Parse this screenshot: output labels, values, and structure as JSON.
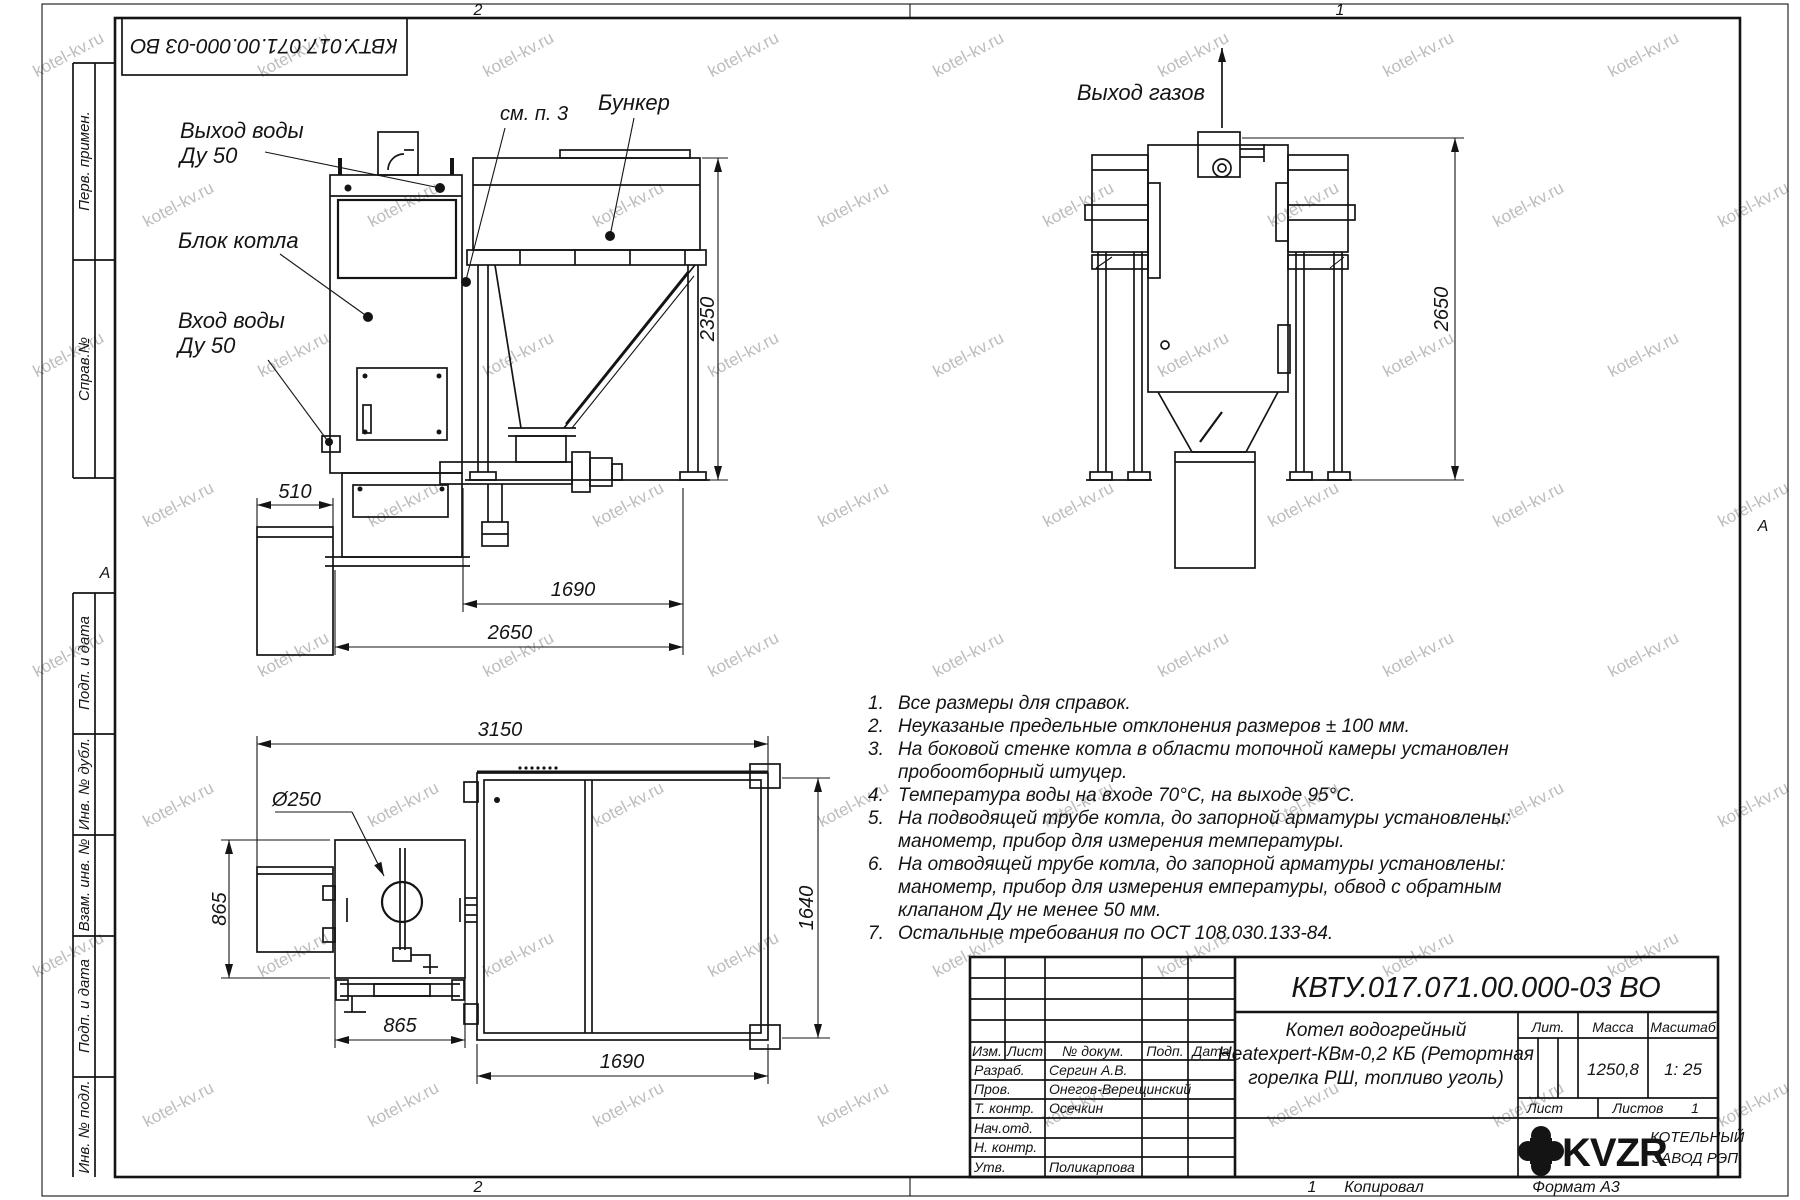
{
  "watermark": {
    "text": "kotel-kv.ru"
  },
  "margins": {
    "zone_top_left": "2",
    "zone_top_right": "1",
    "zone_bottom_left": "2",
    "zone_bottom_right": "1",
    "row_marker_left": "А",
    "row_marker_right": "А",
    "copied": "Копировал",
    "format": "Формат А3",
    "top_stamp": "КВТУ.017.071.00.000-03 ВО"
  },
  "sidebar": {
    "perv": "Перв. примен.",
    "sprav": "Справ.№",
    "podp1": "Подп. и дата",
    "inv_dubl": "Инв. № дубл.",
    "vzam": "Взам. инв. №",
    "podp2": "Подп. и дата",
    "inv_podl": "Инв. № подл."
  },
  "front_view": {
    "water_out_line1": "Выход воды",
    "water_out_line2": "Ду 50",
    "boiler_block": "Блок котла",
    "water_in_line1": "Вход воды",
    "water_in_line2": "Ду 50",
    "see_note": "см. п. 3",
    "bunker": "Бункер",
    "dim_510": "510",
    "dim_2350": "2350",
    "dim_1690": "1690",
    "dim_2650": "2650"
  },
  "side_view": {
    "gas_out": "Выход газов",
    "dim_2650": "2650"
  },
  "top_view": {
    "dim_3150": "3150",
    "dim_diameter": "Ø250",
    "dim_865_left": "865",
    "dim_865_bottom": "865",
    "dim_1690": "1690",
    "dim_1640": "1640"
  },
  "notes": {
    "items": [
      {
        "num": "1.",
        "text": "Все размеры для справок."
      },
      {
        "num": "2.",
        "text": "Неуказаные предельные отклонения размеров ± 100 мм."
      },
      {
        "num": "3.",
        "text": "На боковой стенке котла в области топочной камеры установлен"
      },
      {
        "num": "",
        "text": "пробоотборный штуцер."
      },
      {
        "num": "4.",
        "text": "Температура воды на входе 70°С, на выходе 95°С."
      },
      {
        "num": "5.",
        "text": "На подводящей трубе котла, до запорной арматуры установлены:"
      },
      {
        "num": "",
        "text": "манометр, прибор для измерения температуры."
      },
      {
        "num": "6.",
        "text": "На отводящей трубе котла, до запорной арматуры установлены:"
      },
      {
        "num": "",
        "text": "манометр, прибор для измерения емпературы, обвод с обратным"
      },
      {
        "num": "",
        "text": "клапаном Ду не менее 50 мм."
      },
      {
        "num": "7.",
        "text": "Остальные требования по ОСТ 108.030.133-84."
      }
    ]
  },
  "title_block": {
    "doc_number": "КВТУ.017.071.00.000-03 ВО",
    "cols": {
      "izm": "Изм.",
      "list": "Лист",
      "doc": "№ докум.",
      "podp": "Подп.",
      "date": "Дата"
    },
    "staff": [
      {
        "role": "Разраб.",
        "name": "Сергин А.В."
      },
      {
        "role": "Пров.",
        "name": "Онегов-Верещинский"
      },
      {
        "role": "Т. контр.",
        "name": "Осечкин"
      },
      {
        "role": "Нач.отд.",
        "name": ""
      },
      {
        "role": "Н. контр.",
        "name": ""
      },
      {
        "role": "Утв.",
        "name": "Поликарпова"
      }
    ],
    "product": {
      "line1": "Котел водогрейный",
      "line2": "Heatexpert-КВм-0,2 КБ (Ретортная",
      "line3": "горелка РШ, топливо уголь)"
    },
    "lit_label": "Лит.",
    "mass_label": "Масса",
    "scale_label": "Масштаб",
    "mass_value": "1250,8",
    "scale_value": "1: 25",
    "sheet_label": "Лист",
    "sheets_label": "Листов",
    "sheets_value": "1",
    "logo": {
      "brand": "KVZR",
      "line1": "КОТЕЛЬНЫЙ",
      "line2": "ЗАВОД РЭП"
    }
  }
}
